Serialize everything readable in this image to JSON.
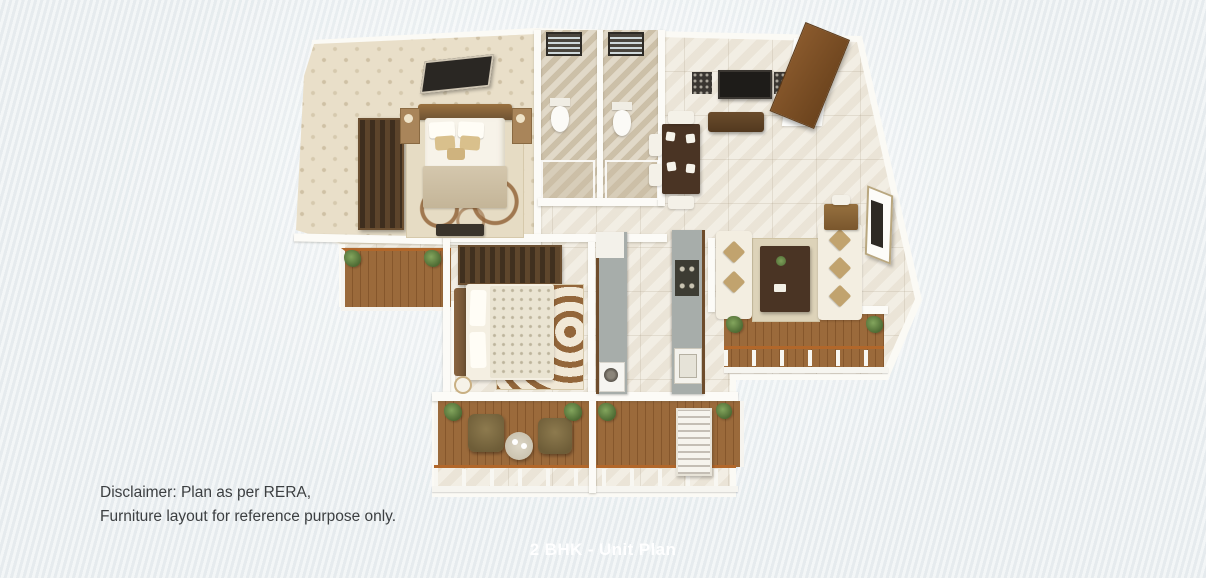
{
  "page": {
    "background_color": "#edf1f3"
  },
  "plan_title": {
    "text": "2 BHK - Unit Plan",
    "color": "#ffffff"
  },
  "disclaimer": {
    "line1": "Disclaimer: Plan as per RERA,",
    "line2": "Furniture layout for reference purpose only.",
    "color": "#3c3f41"
  },
  "floorplan": {
    "kind": "3D rendered unit plan, top-down perspective",
    "unit_type": "2 BHK",
    "rooms": [
      "master-bedroom",
      "master-balcony",
      "bathroom-1",
      "bathroom-2",
      "dining-foyer",
      "entrance",
      "kitchen",
      "bedroom-2",
      "living-room",
      "living-balcony",
      "deck-sitout-left",
      "deck-sitout-right"
    ],
    "palette": {
      "wall": "#fcfbf7",
      "floor_tile": "#efe9dd",
      "master_floor": "#e9dfc9",
      "bath_floor": "#d6cab3",
      "deck_wood": "#96653a",
      "rail_accent": "#b2672a",
      "dark_wood_furniture": "#4a3424",
      "sofa_fabric": "#f3eee1",
      "cushion_accent": "#c1a36e",
      "plant_green": "#5d7a42"
    }
  }
}
